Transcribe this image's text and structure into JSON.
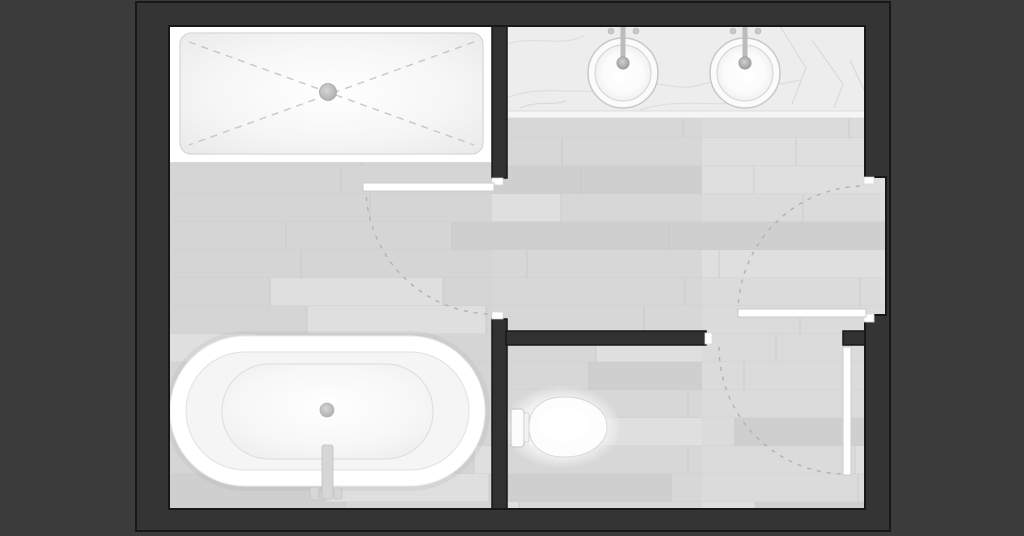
{
  "scene": {
    "kind": "bathroom-floor-plan",
    "view": "top-down",
    "rooms": [
      {
        "name": "shower-and-bath-room"
      },
      {
        "name": "vanity-area"
      },
      {
        "name": "wc-room"
      }
    ],
    "fixtures": [
      {
        "name": "shower-tray",
        "features": [
          "dashed-slope-cross-lines",
          "center-drain"
        ]
      },
      {
        "name": "vanity-counter",
        "features": [
          "marble-veining",
          "double-sink"
        ]
      },
      {
        "name": "sink-left",
        "features": [
          "round-basin",
          "faucet",
          "two-handles"
        ]
      },
      {
        "name": "sink-right",
        "features": [
          "round-basin",
          "faucet",
          "two-handles"
        ]
      },
      {
        "name": "bathtub",
        "features": [
          "freestanding-oval",
          "center-drain",
          "floor-mounted-faucet"
        ]
      },
      {
        "name": "toilet",
        "features": [
          "tank",
          "elongated-bowl"
        ]
      }
    ],
    "doors": [
      {
        "name": "main-room-door",
        "state": "open-90",
        "swing": "quarter-arc"
      },
      {
        "name": "entry-door",
        "state": "open-90",
        "swing": "quarter-arc"
      },
      {
        "name": "wc-door",
        "state": "open-90",
        "swing": "quarter-arc"
      }
    ]
  },
  "palette": {
    "background": "#3b3b3b",
    "wall_fill": "#343434",
    "wall_outline": "#181818",
    "interior_wall_fill": "#313131",
    "door_jamb": "#ffffff",
    "door_leaf": "#ffffff",
    "door_leaf_outline": "#cbcbcb",
    "swing_arc": "#b2b2b2",
    "floor_left": "#d5d5d5",
    "floor_mid": "#d7d7d7",
    "floor_right": "#dbdbdb",
    "floor_light": "#dfdfdf",
    "floor_dark": "#cfcfcf",
    "floor_line": "#c9c9c9",
    "floor_joint": "#c5c5c5",
    "fixture_white": "#ffffff",
    "fixture_outline": "#d8d8d8",
    "shower_dash": "#c7c7c7",
    "counter_fill": "#ededed",
    "counter_vein": "#dedede",
    "metal": "#bcbcbc",
    "drain": "#c9c9c9"
  }
}
